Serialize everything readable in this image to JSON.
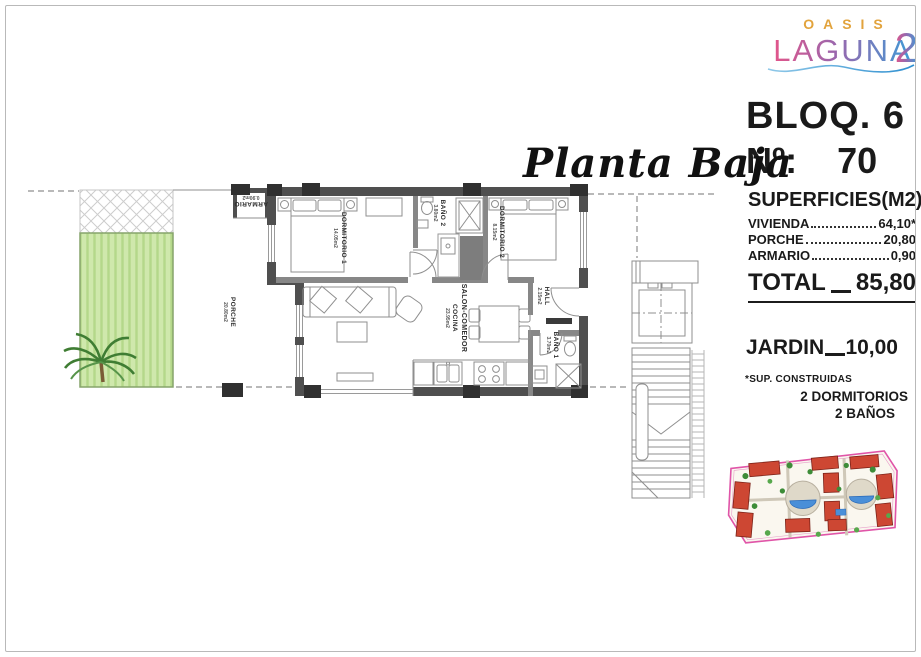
{
  "logo": {
    "top": "OASIS",
    "main": "LAGUNA",
    "sup": "2"
  },
  "header": {
    "bloq": "BLOQ. 6",
    "num_label": "Nº:",
    "num": "70"
  },
  "plan_title": "Planta Baja",
  "superficies": {
    "title": "SUPERFICIES(M2)",
    "rows": [
      {
        "label": "VIVIENDA",
        "value": "64,10*"
      },
      {
        "label": "PORCHE",
        "value": "20,80"
      },
      {
        "label": "ARMARIO",
        "value": "0,90"
      }
    ],
    "total_label": "TOTAL",
    "total_value": "85,80"
  },
  "jardin": {
    "label": "JARDIN",
    "value": "10,00"
  },
  "notes": {
    "footnote": "*SUP. CONSTRUIDAS",
    "features": [
      "2 DORMITORIOS",
      "2 BAÑOS"
    ]
  },
  "rooms": {
    "dorm1": {
      "name": "DORMITORIO 1",
      "area": "14.05m2"
    },
    "bano2": {
      "name": "BAÑO 2",
      "area": "3.80m2"
    },
    "dorm2": {
      "name": "DORMITORIO 2",
      "area": "8.15m2"
    },
    "salon": {
      "name": "SALON-COMEDOR",
      "name2": "COCINA",
      "area": "23.95m2"
    },
    "hall": {
      "name": "HALL",
      "area": "2.15m2"
    },
    "bano1": {
      "name": "BAÑO 1",
      "area": "3.70m2"
    },
    "porche": {
      "name": "PORCHE",
      "area": "20.80m2"
    },
    "armario": {
      "name": "ARMARIO",
      "area": "0.90m2"
    }
  },
  "colors": {
    "wall": "#4f4f4f",
    "garden_fill": "#cfe8ac",
    "logo_orange": "#e2a33c",
    "logo_gradient": [
      "#e2558a",
      "#9a67ad",
      "#3e9bd6"
    ],
    "siteplan_outline": "#e055a8",
    "siteplan_building": "#cd4733",
    "siteplan_pool": "#4a8fd8"
  }
}
